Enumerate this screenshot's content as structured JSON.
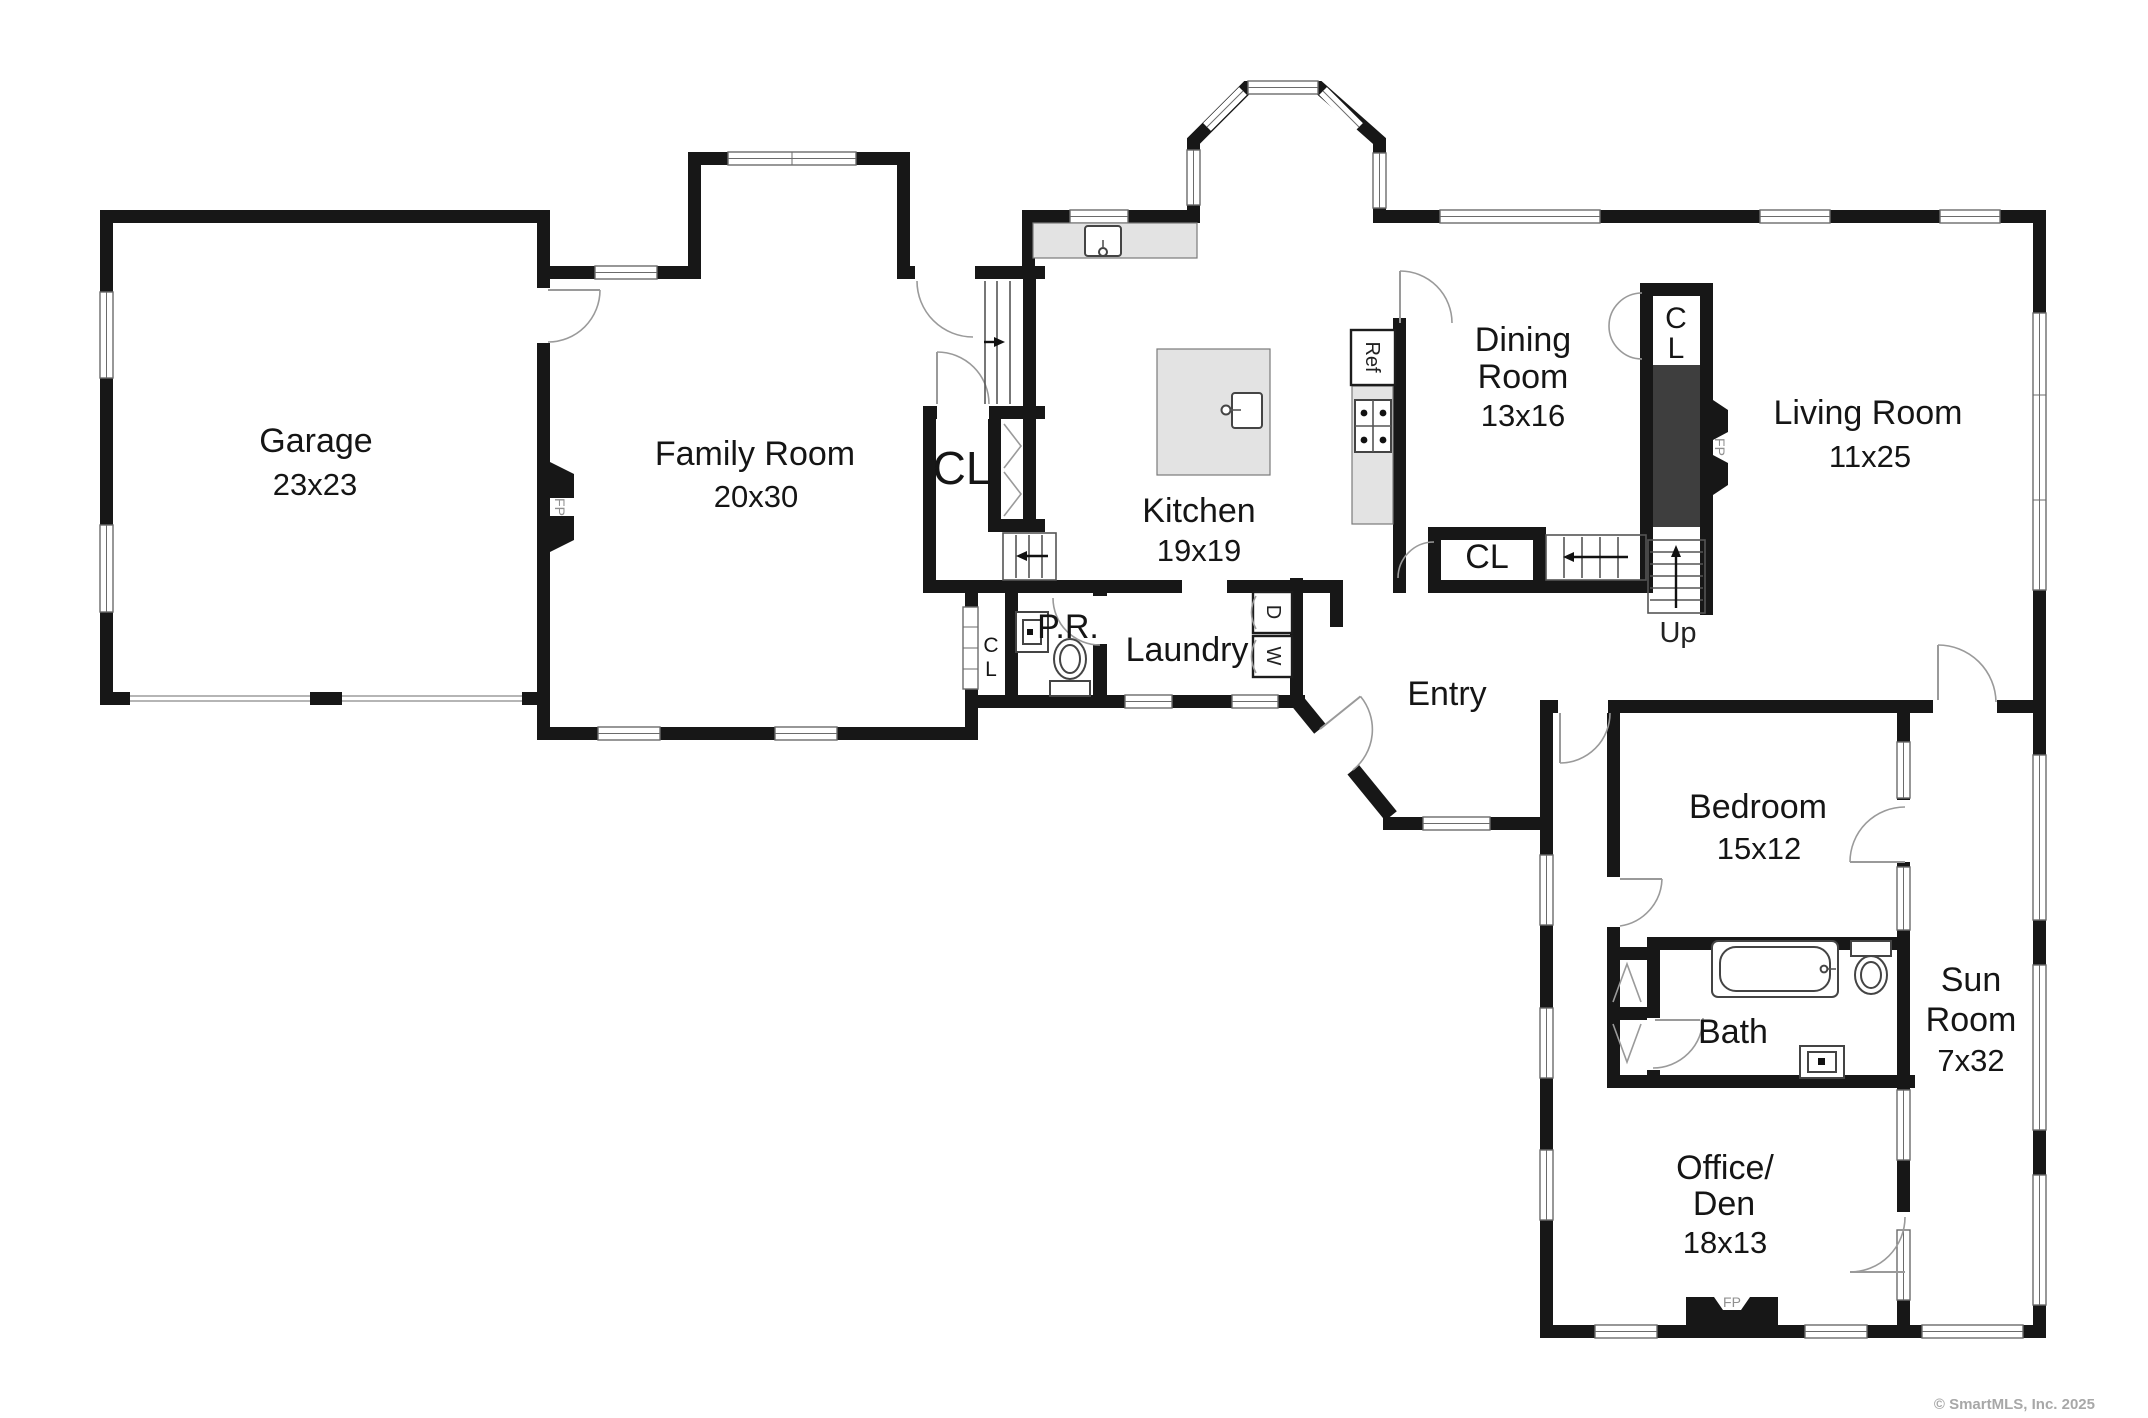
{
  "plan": {
    "rooms": {
      "garage": {
        "name": "Garage",
        "dims": "23x23"
      },
      "family_room": {
        "name": "Family Room",
        "dims": "20x30"
      },
      "kitchen": {
        "name": "Kitchen",
        "dims": "19x19"
      },
      "dining_room": {
        "line1": "Dining",
        "line2": "Room",
        "dims": "13x16"
      },
      "living_room": {
        "name": "Living Room",
        "dims": "11x25"
      },
      "entry": {
        "name": "Entry"
      },
      "laundry": {
        "name": "Laundry"
      },
      "powder_room": {
        "name": "P.R."
      },
      "bedroom": {
        "name": "Bedroom",
        "dims": "15x12"
      },
      "bath": {
        "name": "Bath"
      },
      "sun_room": {
        "line1": "Sun",
        "line2": "Room",
        "dims": "7x32"
      },
      "office_den": {
        "line1": "Office/",
        "line2": "Den",
        "dims": "18x13"
      }
    },
    "closets": {
      "hall_closet": "CL",
      "dining_closet": "CL",
      "living_closet_c": "C",
      "living_closet_l": "L",
      "powder_closet_c": "C",
      "powder_closet_l": "L"
    },
    "stairs": {
      "up_label": "Up"
    },
    "fixtures": {
      "fireplace": "FP",
      "refrigerator": "Ref",
      "washer": "W",
      "dryer": "D"
    },
    "colors": {
      "wall": "#171717",
      "counter": "#e3e3e3",
      "chimney": "#3e3e3e"
    },
    "footer": {
      "copyright": "© SmartMLS, Inc. 2025"
    }
  }
}
